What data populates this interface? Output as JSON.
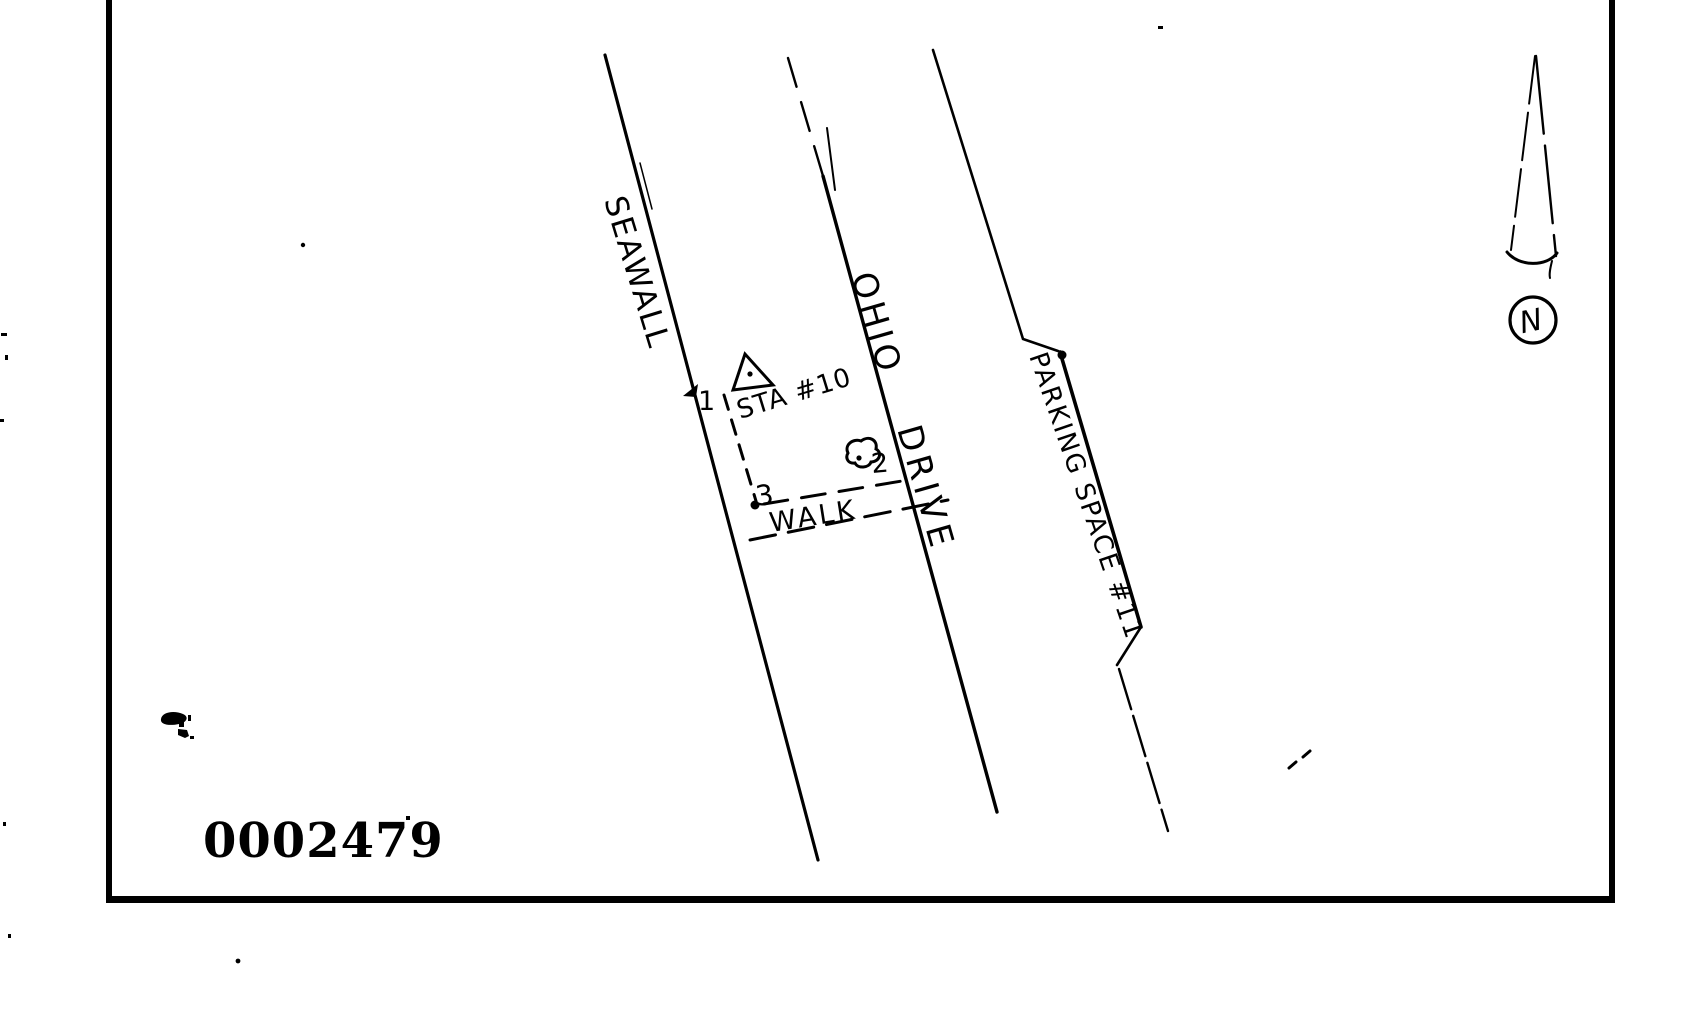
{
  "sketch": {
    "streets": {
      "seawall_label": "SEAWALL",
      "ohio_label": "OHIO",
      "drive_label": "DRIVE",
      "parking_label": "PARKING SPACE #11"
    },
    "features": {
      "walk_label": "WALK",
      "station_label": "STA #10"
    },
    "points": {
      "p1": "1",
      "p2": "2",
      "p3": "3"
    },
    "compass": {
      "north_label": "N"
    },
    "stamp": {
      "number": "0002479"
    },
    "colors": {
      "ink": "#000000",
      "paper": "#ffffff"
    }
  }
}
